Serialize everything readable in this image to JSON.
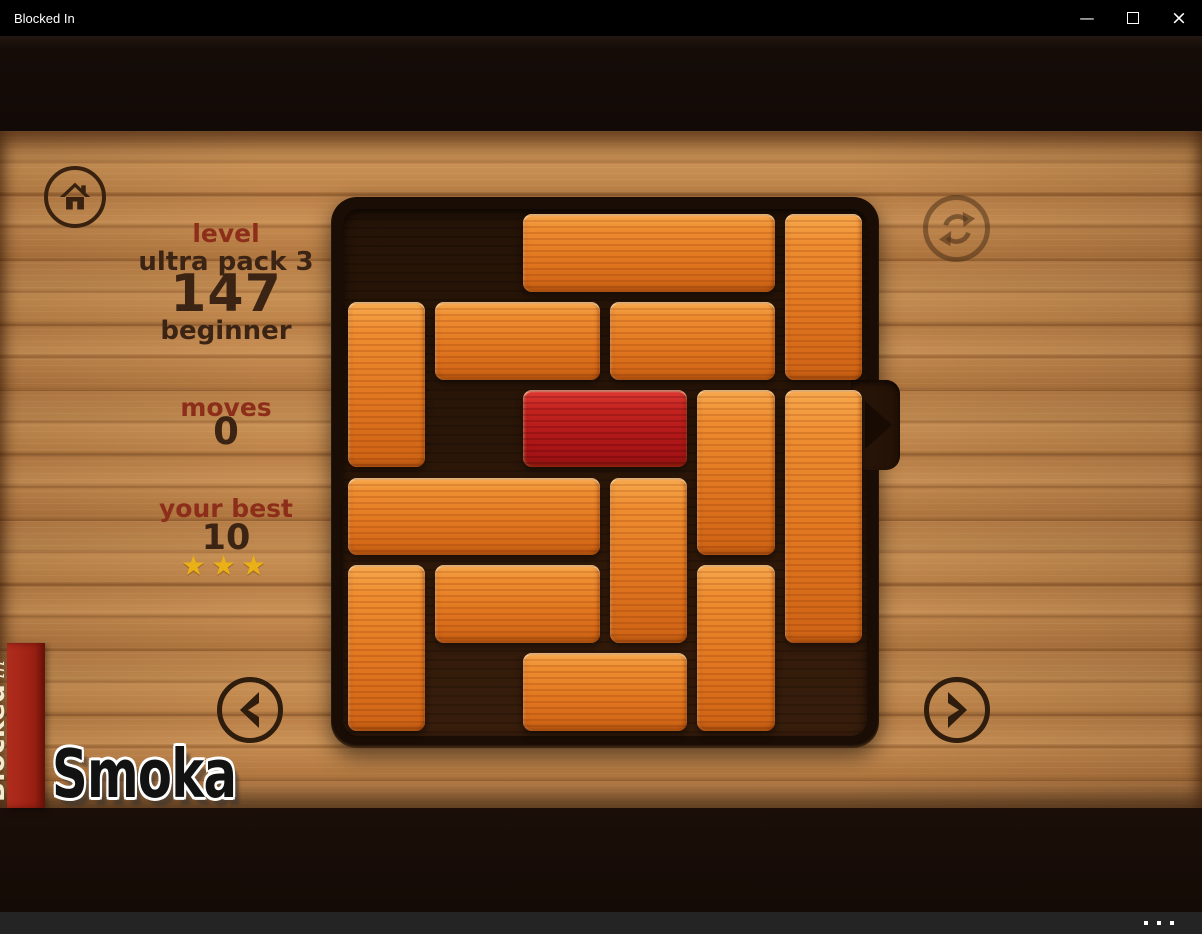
{
  "window": {
    "title": "Blocked In",
    "controls": {
      "minimize": "—",
      "close": "×"
    }
  },
  "hud": {
    "level_label": "level",
    "pack_name": "ultra pack 3",
    "level_number": "147",
    "difficulty": "beginner",
    "moves_label": "moves",
    "moves_value": "0",
    "best_label": "your best",
    "best_value": "10",
    "stars": "★★★",
    "star_count": 3
  },
  "banner": {
    "title": "Blocked",
    "subtitle": "in"
  },
  "watermark": "Smoka",
  "board": {
    "grid": {
      "rows": 6,
      "cols": 6
    },
    "exit": {
      "row": 3,
      "side": "right"
    },
    "pieces": [
      {
        "row": 1,
        "col": 3,
        "len": 3,
        "dir": "h",
        "color": "orange"
      },
      {
        "row": 1,
        "col": 6,
        "len": 2,
        "dir": "v",
        "color": "orange"
      },
      {
        "row": 2,
        "col": 1,
        "len": 2,
        "dir": "v",
        "color": "orange"
      },
      {
        "row": 2,
        "col": 2,
        "len": 2,
        "dir": "h",
        "color": "orange"
      },
      {
        "row": 2,
        "col": 4,
        "len": 2,
        "dir": "h",
        "color": "orange"
      },
      {
        "row": 3,
        "col": 3,
        "len": 2,
        "dir": "h",
        "color": "red"
      },
      {
        "row": 3,
        "col": 5,
        "len": 2,
        "dir": "v",
        "color": "orange"
      },
      {
        "row": 3,
        "col": 6,
        "len": 3,
        "dir": "v",
        "color": "orange"
      },
      {
        "row": 4,
        "col": 1,
        "len": 3,
        "dir": "h",
        "color": "orange"
      },
      {
        "row": 4,
        "col": 4,
        "len": 2,
        "dir": "v",
        "color": "orange"
      },
      {
        "row": 5,
        "col": 1,
        "len": 2,
        "dir": "v",
        "color": "orange"
      },
      {
        "row": 5,
        "col": 2,
        "len": 2,
        "dir": "h",
        "color": "orange"
      },
      {
        "row": 5,
        "col": 5,
        "len": 2,
        "dir": "v",
        "color": "orange"
      },
      {
        "row": 6,
        "col": 3,
        "len": 2,
        "dir": "h",
        "color": "orange"
      }
    ]
  },
  "colors": {
    "accent_red_text": "#8d2e1a",
    "dark_brown_text": "#3b2414",
    "star_gold": "#eab117",
    "block_orange": "#e0761f",
    "block_red": "#c4231f",
    "banner_red": "#a02315"
  },
  "icons": {
    "home": "house-icon",
    "restart": "circular-arrows-icon",
    "prev": "chevron-left-icon",
    "next": "chevron-right-icon",
    "exit": "arrow-right-icon",
    "menu": "ellipsis-icon"
  }
}
